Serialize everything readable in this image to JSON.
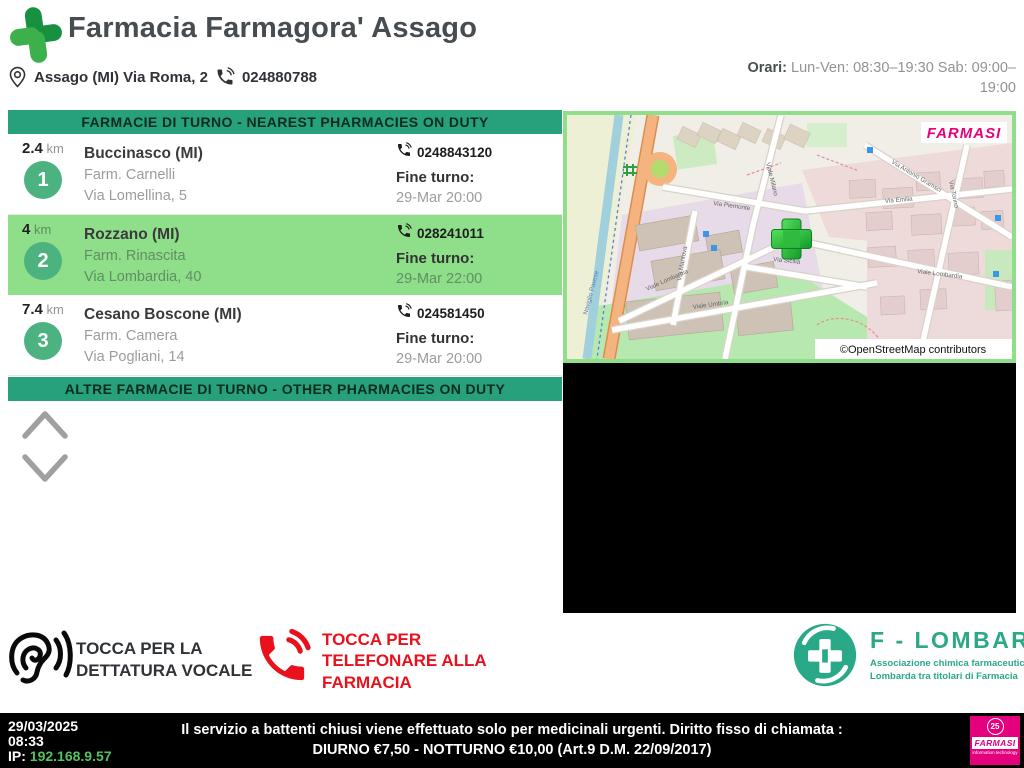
{
  "header": {
    "title": "Farmacia Farmagora' Assago",
    "address": "Assago (MI) Via Roma, 2",
    "phone": "024880788",
    "hours_label": "Orari:",
    "hours_value": " Lun-Ven: 08:30–19:30 Sab: 09:00–19:00"
  },
  "duty_list": {
    "banner_nearest": "FARMACIE DI TURNO - NEAREST PHARMACIES ON DUTY",
    "banner_other": "ALTRE FARMACIE DI TURNO - OTHER PHARMACIES ON DUTY",
    "fine_turno_label": "Fine turno:",
    "items": [
      {
        "rank": "1",
        "distance": "2.4",
        "unit": " km",
        "city": "Buccinasco (MI)",
        "name": "Farm. Carnelli",
        "street": "Via Lomellina, 5",
        "phone": "0248843120",
        "end": "29-Mar 20:00"
      },
      {
        "rank": "2",
        "distance": "4",
        "unit": " km",
        "city": "Rozzano (MI)",
        "name": "Farm. Rinascita",
        "street": "Via Lombardia, 40",
        "phone": "028241011",
        "end": "29-Mar 22:00"
      },
      {
        "rank": "3",
        "distance": "7.4",
        "unit": " km",
        "city": "Cesano Boscone (MI)",
        "name": "Farm. Camera",
        "street": "Via Pogliani, 14",
        "phone": "024581450",
        "end": "29-Mar 20:00"
      }
    ]
  },
  "map": {
    "brand": "FARMASI",
    "attribution": "©OpenStreetMap contributors",
    "street_labels": [
      "Via Piemonte",
      "Viale Milano",
      "Via Emilia",
      "Viale Lombardia",
      "Via Torino",
      "Via Antonio Gramsci",
      "Viale Umbria",
      "Via Mantova",
      "Via Sicilia",
      "Naviglio Pavese"
    ]
  },
  "actions": {
    "dictation": "TOCCA PER LA DETTATURA VOCALE",
    "call": "TOCCA PER TELEFONARE ALLA FARMACIA"
  },
  "flombarda": {
    "name": "F - LOMBARDA",
    "subtitle": "Associazione chimica farmaceutica Lombarda tra titolari di Farmacia"
  },
  "footer": {
    "date": "29/03/2025",
    "time": "08:33",
    "ip_label": "IP: ",
    "ip": "192.168.9.57",
    "notice": "Il servizio a battenti chiusi viene effettuato solo per medicinali urgenti. Diritto fisso di chiamata : DIURNO €7,50 - NOTTURNO €10,00 (Art.9 D.M. 22/09/2017)",
    "farmasi_brand": "FARMASI",
    "farmasi_badge": "25",
    "farmasi_sub": "information technology"
  },
  "colors": {
    "banner_teal": "#26a17b",
    "row_highlight": "#8ede8a",
    "badge_green": "#4cb380",
    "action_red": "#e8111c",
    "flombarda_teal": "#2aa988",
    "farmasi_magenta": "#e5007d",
    "ip_green": "#55c25e"
  }
}
